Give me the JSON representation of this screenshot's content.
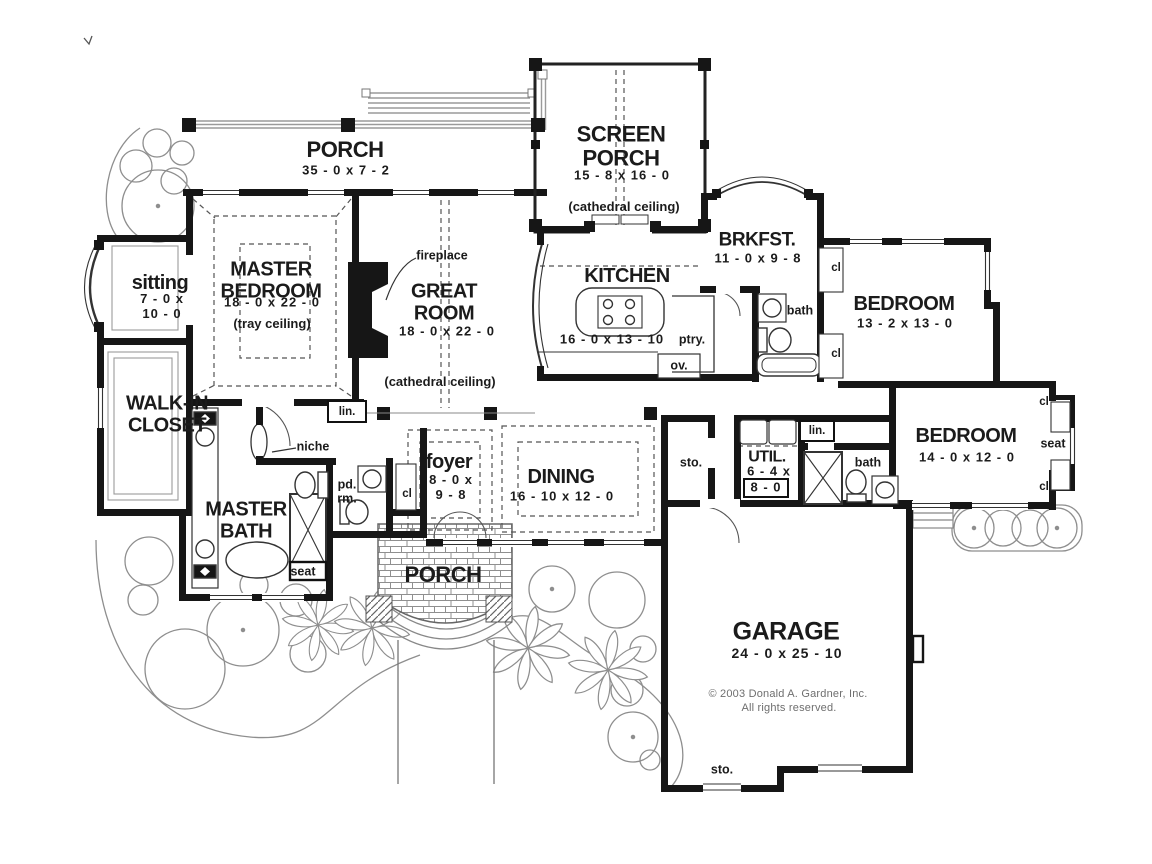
{
  "meta": {
    "copyright": "© 2003 Donald A. Gardner, Inc.",
    "rights": "All rights reserved."
  },
  "colors": {
    "ink": "#161616",
    "landscape": "#8e8e8e",
    "deck": "#9a9a9a"
  },
  "rooms": {
    "porch_top": {
      "name": "PORCH",
      "dims": "35 - 0 x 7 - 2"
    },
    "screen_porch": {
      "name": "SCREEN PORCH",
      "dims": "15 - 8 x 16 - 0",
      "note": "(cathedral ceiling)"
    },
    "brkfst": {
      "name": "BRKFST.",
      "dims": "11 - 0 x 9 - 8"
    },
    "sitting": {
      "name": "sitting",
      "dims": "7 - 0 x\n10 - 0"
    },
    "master_bedroom": {
      "name": "MASTER BEDROOM",
      "dims": "18 - 0 x 22 - 0",
      "note": "(tray ceiling)"
    },
    "great_room": {
      "name": "GREAT ROOM",
      "dims": "18 - 0 x 22 - 0",
      "note": "(cathedral ceiling)"
    },
    "kitchen": {
      "name": "KITCHEN",
      "dims": "16 - 0 x 13 - 10"
    },
    "bedroom1": {
      "name": "BEDROOM",
      "dims": "13 - 2 x 13 - 0"
    },
    "bedroom2": {
      "name": "BEDROOM",
      "dims": "14 - 0 x 12 - 0"
    },
    "walk_in_closet": {
      "name": "WALK-IN CLOSET"
    },
    "master_bath": {
      "name": "MASTER BATH"
    },
    "foyer": {
      "name": "foyer",
      "dims": "8 - 0 x\n9 - 8"
    },
    "dining": {
      "name": "DINING",
      "dims": "16 - 10 x 12 - 0"
    },
    "util": {
      "name": "UTIL.",
      "dims_line1": "6 - 4 x",
      "dims_line2": "8 - 0"
    },
    "garage": {
      "name": "GARAGE",
      "dims": "24 - 0 x 25 - 10"
    },
    "porch_bottom": {
      "name": "PORCH"
    }
  },
  "labels": {
    "fireplace": "fireplace",
    "niche": "niche",
    "lin": "lin.",
    "bath": "bath",
    "ptry": "ptry.",
    "ov": "ov.",
    "cl": "cl",
    "sto": "sto.",
    "seat": "seat",
    "pd_rm": "pd.\nrm."
  }
}
